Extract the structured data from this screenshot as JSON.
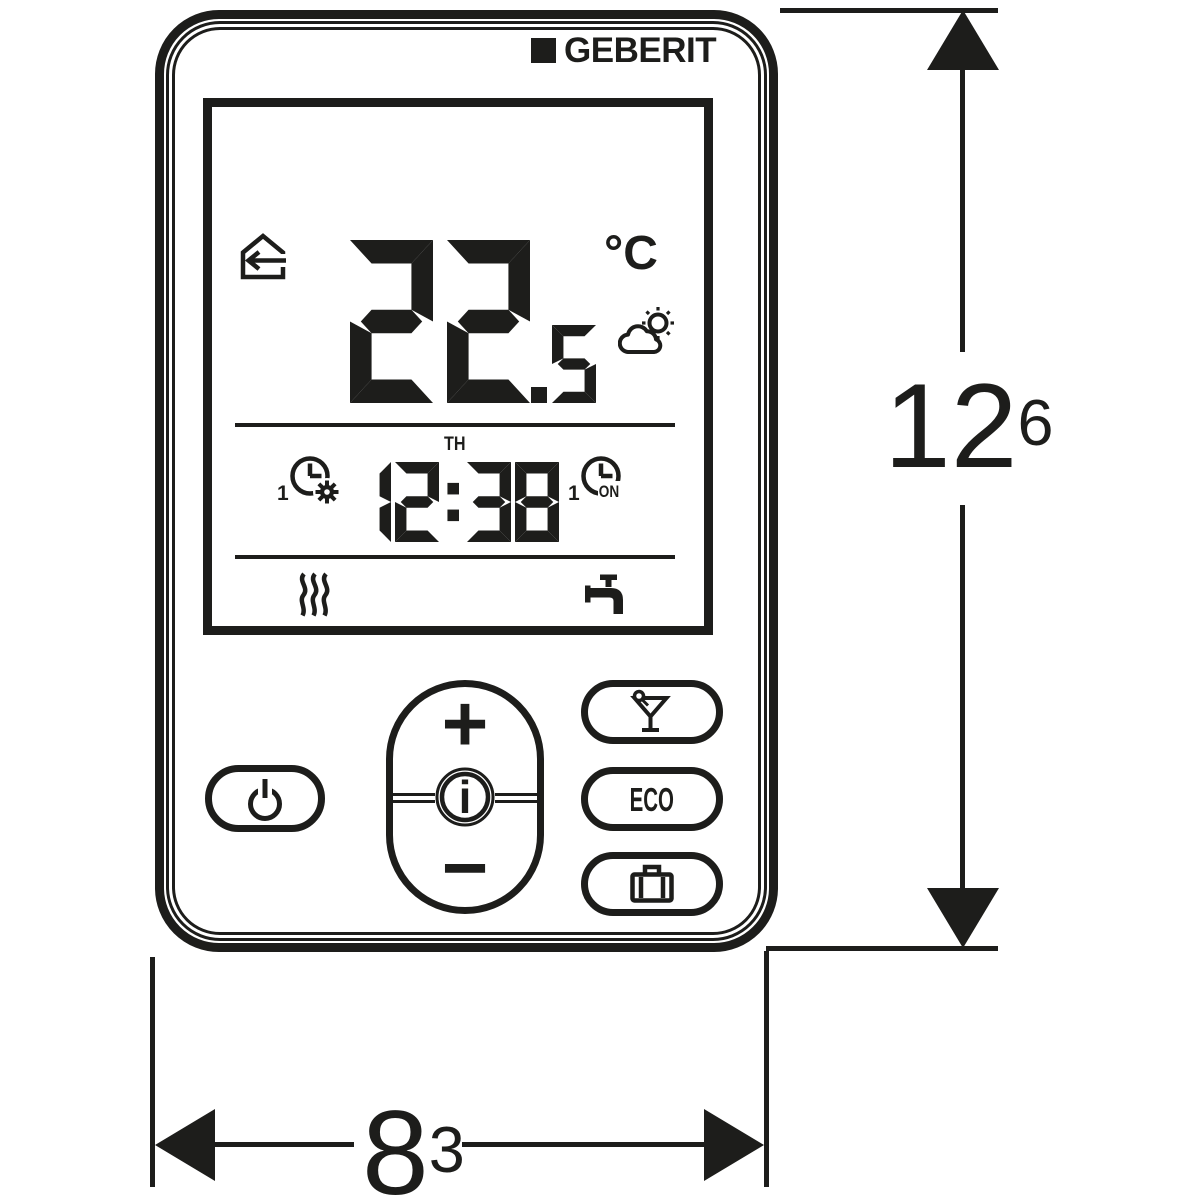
{
  "colors": {
    "ink": "#1d1d1b",
    "background": "#ffffff"
  },
  "brand": {
    "logo_text": "GEBERIT",
    "logo_mark": "black-square"
  },
  "display": {
    "home_icon": "house-with-left-arrow",
    "temperature_integer": "22",
    "temperature_decimal": "5",
    "temperature_unit": "°C",
    "weather_icon": "sun-behind-cloud",
    "day": "TH",
    "time": "12:38",
    "program_comfort": {
      "number": "1",
      "icon": "clock-with-gear"
    },
    "program_on": {
      "number": "1",
      "label": "ON",
      "icon": "clock"
    },
    "status": {
      "heating_icon": "heat-waves",
      "water_icon": "water-tap"
    }
  },
  "buttons": {
    "power_icon": "power-symbol",
    "plus": "+",
    "info": "i",
    "minus": "−",
    "party_icon": "cocktail-glass",
    "eco": "ECO",
    "holiday_icon": "briefcase"
  },
  "dimensions": {
    "height_value": "12",
    "height_sup": "6",
    "width_value": "8",
    "width_sup": "3"
  }
}
